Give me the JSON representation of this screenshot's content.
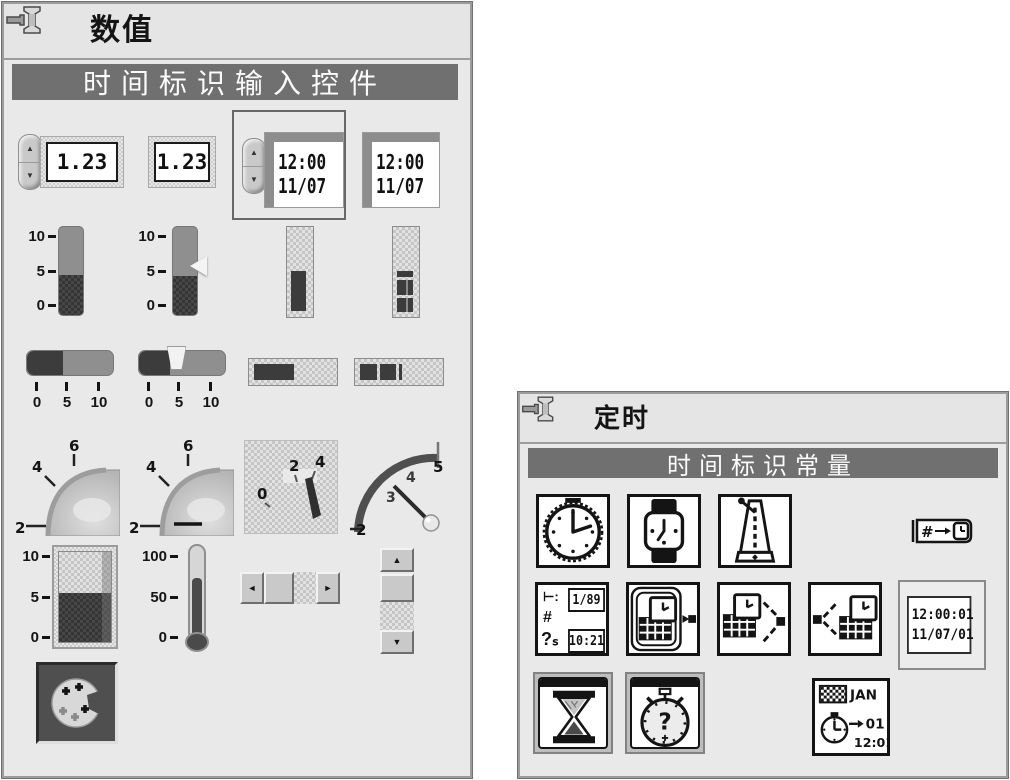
{
  "left_palette": {
    "title": "数值",
    "banner": "时间标识输入控件",
    "numeric_control_value": "1.23",
    "numeric_indicator_value": "1.23",
    "timestamp_control": {
      "time": "12:00",
      "date": "11/07"
    },
    "timestamp_indicator": {
      "time": "12:00",
      "date": "11/07"
    },
    "vslider_scale": [
      "10",
      "5",
      "0"
    ],
    "hslider_scale": [
      "0",
      "5",
      "10"
    ],
    "knob_scale": [
      "2",
      "4",
      "6"
    ],
    "meter_scale": [
      "0",
      "2",
      "4"
    ],
    "gauge_scale": [
      "2",
      "3",
      "4",
      "5"
    ],
    "tank_scale": [
      "10",
      "5",
      "0"
    ],
    "thermo_scale": [
      "100",
      "50",
      "0"
    ]
  },
  "right_palette": {
    "title": "定时",
    "banner": "时间标识常量",
    "format_icon": {
      "l1": "⊢:",
      "l2": "#",
      "l3": "?ₛ",
      "box1": "1/89",
      "box2": "10:21"
    },
    "to_timestamp_hash": "#",
    "timestamp_constant": {
      "time": "12:00:01",
      "date": "11/07/01"
    },
    "datetime_string_icon": {
      "month": "JAN",
      "day": "01",
      "time": "12:01"
    },
    "elapsed_q": "?"
  }
}
